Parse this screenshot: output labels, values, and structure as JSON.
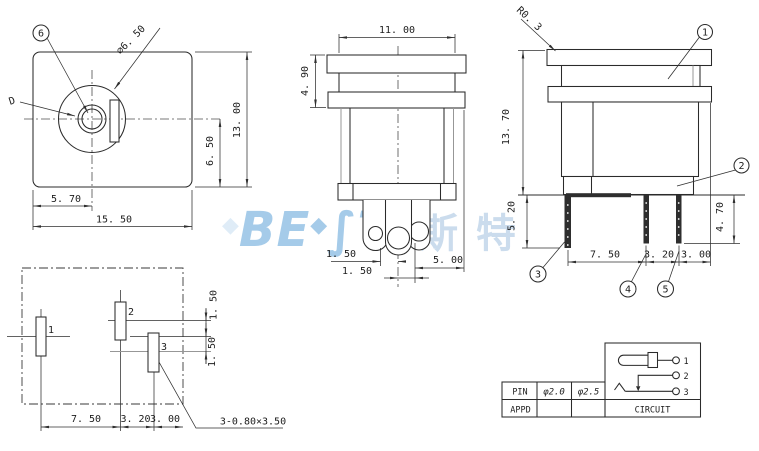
{
  "watermark": {
    "latin_a": "BE",
    "diamond": "◆",
    "latin_b": "∫T",
    "cn": "斯特"
  },
  "front_view": {
    "balloon": "6",
    "d_label": "D",
    "dia_label": "⌀6. 50",
    "dim_height": "13. 00",
    "dim_center_bottom": "6. 50",
    "dim_left_center": "5. 70",
    "dim_width": "15. 50"
  },
  "side_view": {
    "dim_width": "11. 00",
    "dim_flange": "4. 90",
    "dim_pin1": "1. 50",
    "dim_pin2": "1. 50",
    "dim_right": "5. 00"
  },
  "rear_view": {
    "radius_label": "R0. 3",
    "dim_height": "13. 70",
    "dim_pin_left": "5. 20",
    "dim_pin_right": "4. 70",
    "dim_pitch1": "7. 50",
    "dim_pitch2": "3. 20",
    "dim_pitch3": "3. 00",
    "balloons": [
      "1",
      "2",
      "3",
      "4",
      "5"
    ]
  },
  "footprint": {
    "pads": [
      "1",
      "2",
      "3"
    ],
    "dim_off1": "1. 50",
    "dim_off2": "1. 50",
    "dim_pitch1": "7. 50",
    "dim_pitch2": "3. 20",
    "dim_pitch3": "3. 00",
    "slot_note": "3-0.80×3.50"
  },
  "table": {
    "pin_label": "PIN",
    "pin_d1": "φ2.0",
    "pin_d2": "φ2.5",
    "appd_label": "APPD",
    "circuit_label": "CIRCUIT",
    "terminals": [
      "1",
      "2",
      "3"
    ]
  }
}
